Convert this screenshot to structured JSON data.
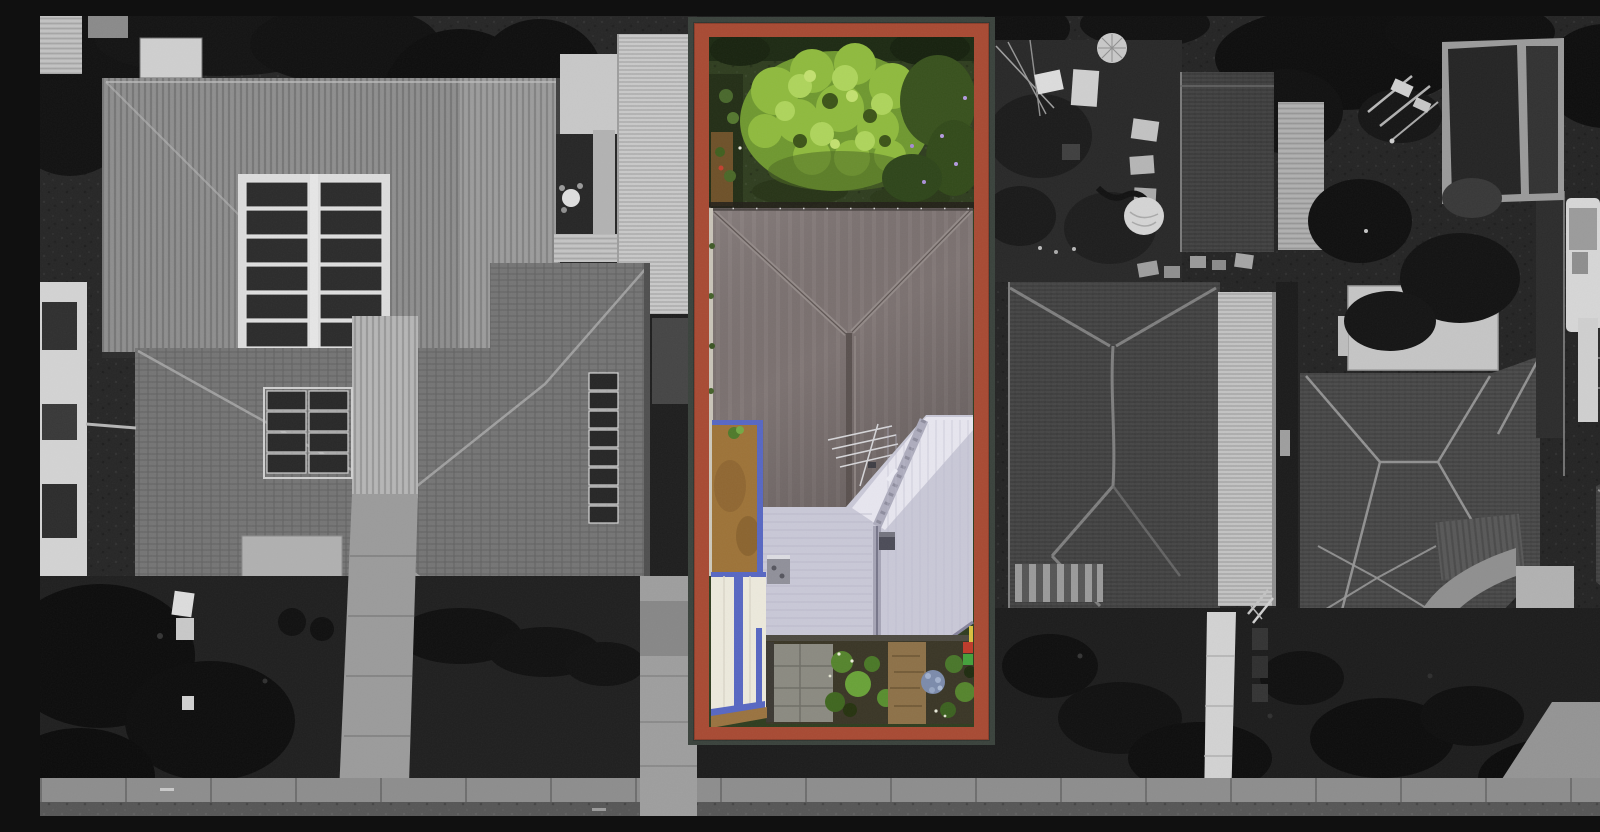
{
  "image": {
    "alt": "Aerial drone photograph of a suburban block; the centre property lot is outlined with a thick red-brown rectangular boundary and shown in full colour, while all neighbouring houses, yards and the street are desaturated to black-and-white.",
    "style": "real-estate listing aerial with highlighted lot"
  },
  "highlight": {
    "shape": "rectangle",
    "border_color": "#a84a33",
    "outline_color": "#3a423c"
  },
  "highlighted_lot": {
    "features": [
      "back-lawn",
      "large-bright-tree-canopy",
      "dark-hip-roof-house",
      "light-gabled-extension-roof",
      "tv-antenna",
      "tan-side-courtyard",
      "blue-trimmed-white-carport",
      "front-garden-with-path",
      "hydrangea-bush",
      "wheelie-bins"
    ]
  },
  "surroundings": {
    "left": [
      "metal-roof-house-with-solar-array",
      "tiled-hip-roof-house-with-solar-panels",
      "boundary-veranda-roof",
      "white-building",
      "driveway",
      "dark-trees"
    ],
    "right": [
      "cluttered-backyard",
      "garage-roof",
      "dark-tiled-house",
      "corrugated-wing",
      "second-tiled-house",
      "dark-shed",
      "caravan",
      "concrete-paths"
    ],
    "bottom": [
      "footpath",
      "road-edge",
      "front-lawns",
      "driveway-crossings"
    ]
  },
  "palette": {
    "red_border": "#a84a33",
    "border_outline": "#3a423c",
    "roof_dark": "#7b7170",
    "roof_light": "#c9c8d7",
    "roof_light_bright": "#e7e6ef",
    "trim_blue": "#5767c2",
    "courtyard_tan": "#9d7338",
    "carport_white": "#ece9dc",
    "lawn_green": "#2f3d1f",
    "canopy_green": "#8fba3e",
    "canopy_green_light": "#aed45c",
    "canopy_green_dark": "#4c6a22",
    "shrub_green": "#55842d",
    "hydrangea_blue": "#7c8bab",
    "bin_red": "#bf3a2a",
    "bin_green": "#43a13b",
    "bin_yellow": "#d9c040",
    "paver_grey": "#8b8a81",
    "path_tan": "#8d7148",
    "mono_bg": "#262626",
    "mono_sidewalk": "#8d8d8d",
    "mono_road": "#565656",
    "mono_metal_roof": "#8e8e8e",
    "mono_tile_roof": "#757575",
    "mono_tile_dark": "#464646",
    "mono_light_panel": "#c9c9c9",
    "mono_tree_dark": "#111111"
  }
}
